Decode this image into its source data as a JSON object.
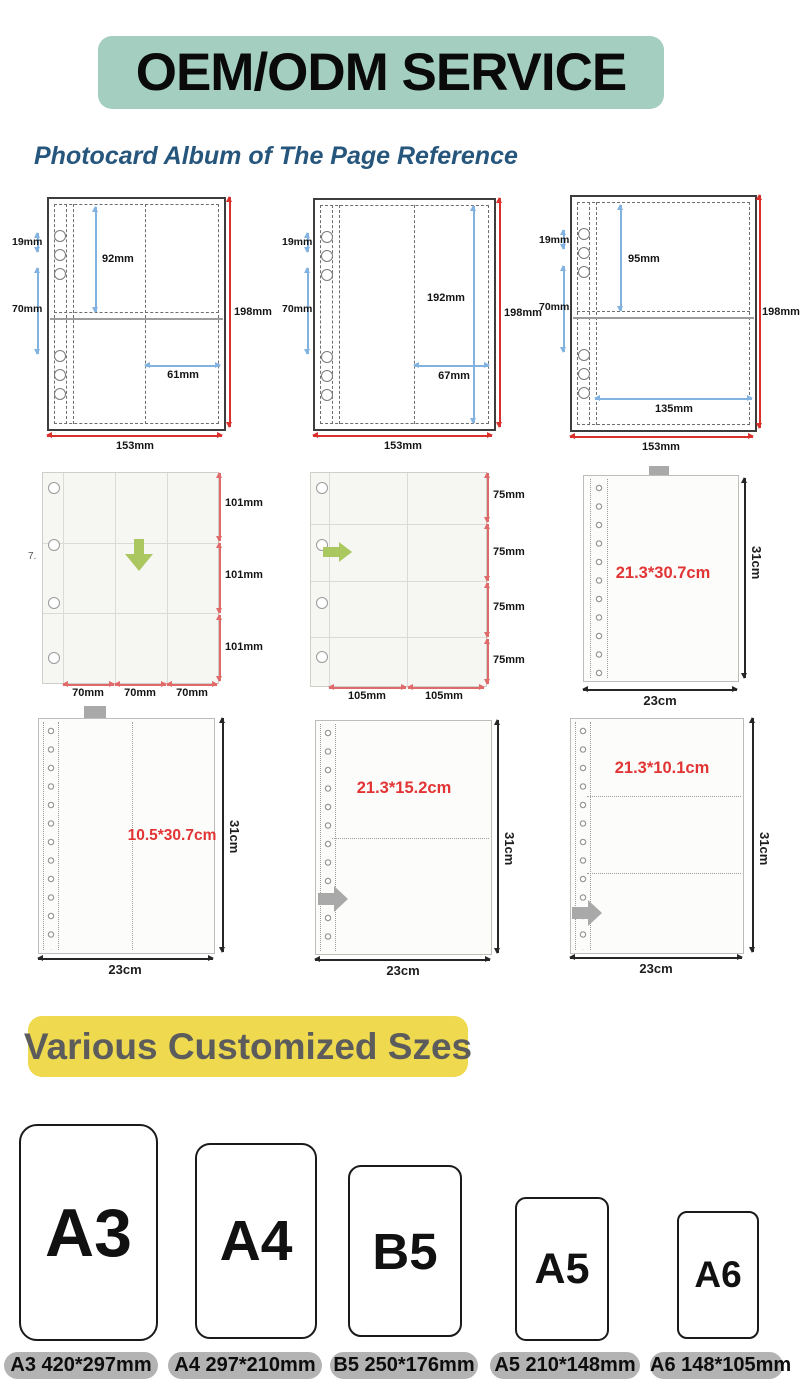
{
  "header": {
    "title": "OEM/ODM SERVICE"
  },
  "intro_title": "Photocard Album of The Page Reference",
  "row1": [
    {
      "hole_gap": "19mm",
      "hole_span": "70mm",
      "pocket_h": "92mm",
      "pocket_w": "61mm",
      "page_h": "198mm",
      "page_w": "153mm"
    },
    {
      "hole_gap": "19mm",
      "hole_span": "70mm",
      "pocket_h": "192mm",
      "pocket_w": "67mm",
      "page_h": "198mm",
      "page_w": "153mm"
    },
    {
      "hole_gap": "19mm",
      "hole_span": "70mm",
      "pocket_h": "95mm",
      "pocket_w": "135mm",
      "page_h": "198mm",
      "page_w": "153mm"
    }
  ],
  "row2": [
    {
      "artifact": "7.",
      "side": [
        "101mm",
        "101mm",
        "101mm"
      ],
      "bottom": [
        "70mm",
        "70mm",
        "70mm"
      ]
    },
    {
      "side": [
        "75mm",
        "75mm",
        "75mm",
        "75mm"
      ],
      "bottom": [
        "105mm",
        "105mm"
      ]
    },
    {
      "pocket": "21.3*30.7cm",
      "height": "31cm",
      "width": "23cm"
    }
  ],
  "row3": [
    {
      "pocket": "10.5*30.7cm",
      "height": "31cm",
      "width": "23cm"
    },
    {
      "pocket": "21.3*15.2cm",
      "height": "31cm",
      "width": "23cm"
    },
    {
      "pocket": "21.3*10.1cm",
      "height": "31cm",
      "width": "23cm"
    }
  ],
  "sizes_title": "Various Customized Szes",
  "sizes": [
    {
      "name": "A3",
      "label": "A3 420*297mm"
    },
    {
      "name": "A4",
      "label": "A4 297*210mm"
    },
    {
      "name": "B5",
      "label": "B5 250*176mm"
    },
    {
      "name": "A5",
      "label": "A5 210*148mm"
    },
    {
      "name": "A6",
      "label": "A6 148*105mm"
    }
  ],
  "colors": {
    "banner_bg": "#a4cfc0",
    "highlight_bg": "#eed94f",
    "dimension_red": "#d9302c",
    "dimension_blue": "#82b3e0",
    "pocket_text_red": "#e23434",
    "arrow_green": "#abc75f",
    "arrow_gray": "#a9a9a9",
    "pill_bg": "#b3b3b3"
  }
}
